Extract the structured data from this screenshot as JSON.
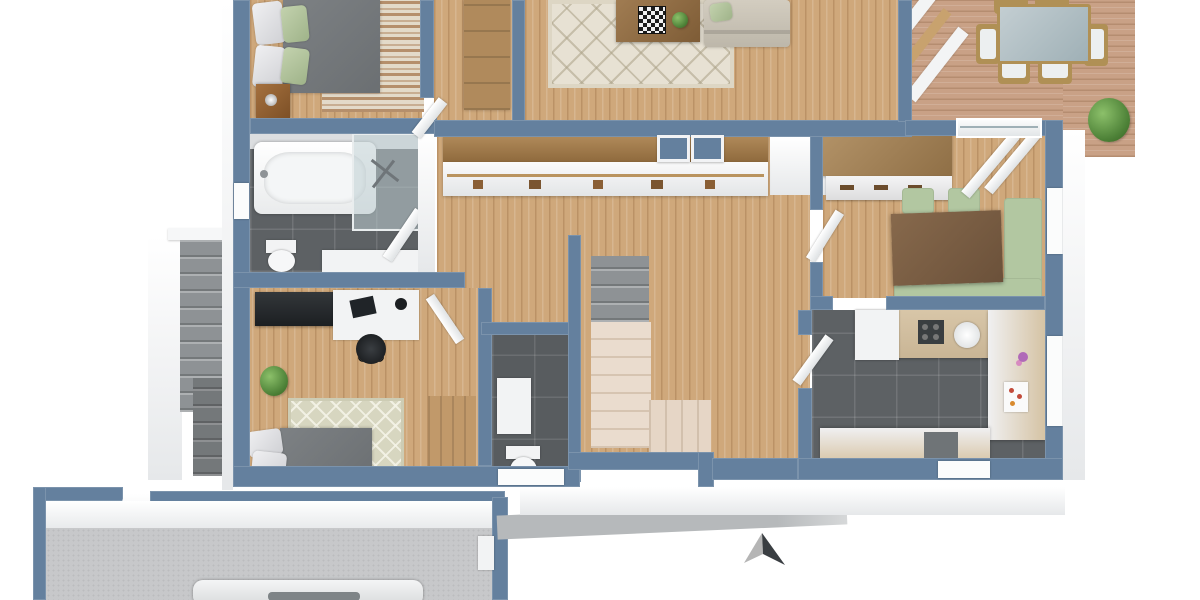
{
  "scene": {
    "description": "3D rendered top-down floor plan of a single-storey house with wooden deck, garage and exterior stairs; no text labels visible",
    "background_color": "#ffffff"
  },
  "palette": {
    "wall_blue": "#64809e",
    "wall_white_face": "#f2f3f5",
    "wood_floor": "#cfa87b",
    "deck_wood": "#c9a186",
    "dark_tile": "#5d6164",
    "garage_concrete": "#c7c8ca",
    "stair_cream": "#eadcce",
    "stair_gray": "#8e9295",
    "accent_green": "#b2c7a1",
    "rug_beige": "#e7e1d3",
    "sofa_beige": "#cbc5b8",
    "bed_gray": "#73777a",
    "dark_table_wood": "#7b6048",
    "sideboard_wood": "#a78a62"
  },
  "compass": {
    "name": "North arrow",
    "light_color": "#b5b5b5",
    "dark_color": "#3a3e42"
  },
  "rooms": {
    "bedroom_main": {
      "name": "Bedroom",
      "furniture": [
        "double bed with grey duvet",
        "two white pillows",
        "two green pillows",
        "wooden nightstand",
        "brown streaked rug"
      ]
    },
    "hall_nook": {
      "name": "Hall wardrobe nook",
      "furniture": [
        "built-in wooden wardrobe"
      ]
    },
    "living_room": {
      "name": "Living room",
      "furniture": [
        "beige lattice rug",
        "wooden coffee table with chessboard",
        "potted plant",
        "beige sofa with green cushion"
      ]
    },
    "hallway": {
      "name": "Hallway",
      "furniture": [
        "long built-in closet with clothes rail",
        "two wall niches"
      ]
    },
    "bathroom": {
      "name": "Bathroom",
      "furniture": [
        "bathtub",
        "glass shower",
        "toilet",
        "white vanity",
        "dark tiled floor"
      ]
    },
    "office_bedroom": {
      "name": "Office / guest bedroom",
      "furniture": [
        "dark sideboard desk",
        "white desk with laptop",
        "black office chair",
        "potted plant",
        "diamond pattern rug",
        "single bed",
        "wooden wardrobe"
      ]
    },
    "wc": {
      "name": "Guest WC",
      "furniture": [
        "toilet",
        "white washbasin",
        "dark tiled floor"
      ]
    },
    "staircase": {
      "name": "Staircase",
      "furniture": [
        "grey upper flight",
        "cream L-shaped flight"
      ]
    },
    "dining_room": {
      "name": "Dining room",
      "furniture": [
        "wooden sideboard",
        "dark wood dining table",
        "two green chairs",
        "green corner bench",
        "sliding glass door to deck"
      ]
    },
    "kitchen": {
      "name": "Kitchen",
      "furniture": [
        "U-shaped white and beige counter",
        "round sink",
        "dark cooktop",
        "fridge",
        "dark tiled floor",
        "purple flowers"
      ]
    },
    "deck": {
      "name": "Wooden deck",
      "furniture": [
        "glass-top outdoor dining table",
        "six wooden deck chairs with white cushions",
        "potted plant"
      ]
    },
    "garage": {
      "name": "Garage",
      "furniture": [
        "white car"
      ]
    },
    "exterior_stairs": {
      "name": "Exterior stairs",
      "furniture": [
        "grey concrete steps"
      ]
    }
  }
}
